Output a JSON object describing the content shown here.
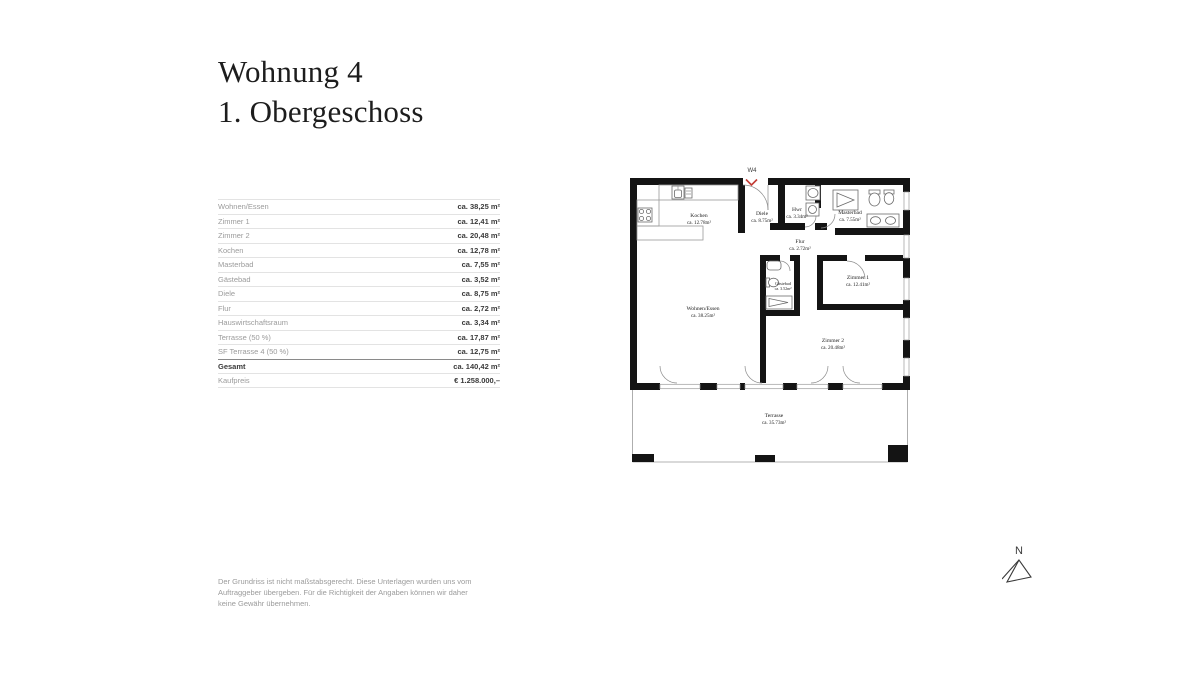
{
  "title": {
    "line1": "Wohnung 4",
    "line2": "1. Obergeschoss"
  },
  "area_table": {
    "rows": [
      {
        "label": "Wohnen/Essen",
        "value": "ca. 38,25 m²"
      },
      {
        "label": "Zimmer 1",
        "value": "ca. 12,41 m²"
      },
      {
        "label": "Zimmer 2",
        "value": "ca. 20,48 m²"
      },
      {
        "label": "Kochen",
        "value": "ca. 12,78 m²"
      },
      {
        "label": "Masterbad",
        "value": "ca. 7,55 m²"
      },
      {
        "label": "Gästebad",
        "value": "ca. 3,52 m²"
      },
      {
        "label": "Diele",
        "value": "ca. 8,75 m²"
      },
      {
        "label": "Flur",
        "value": "ca. 2,72 m²"
      },
      {
        "label": "Hauswirtschaftsraum",
        "value": "ca. 3,34 m²"
      },
      {
        "label": "Terrasse (50 %)",
        "value": "ca. 17,87 m²"
      },
      {
        "label": "SF Terrasse 4 (50 %)",
        "value": "ca. 12,75 m²"
      }
    ],
    "total": {
      "label": "Gesamt",
      "value": "ca. 140,42 m²"
    },
    "price": {
      "label": "Kaufpreis",
      "value": "€ 1.258.000,–"
    }
  },
  "floorplan": {
    "unit_label": "W4",
    "rooms": [
      {
        "name": "Kochen",
        "area": "ca. 12.78m²"
      },
      {
        "name": "Diele",
        "area": "ca. 8.75m²"
      },
      {
        "name": "Hwr",
        "area": "ca. 3.34m²"
      },
      {
        "name": "Masterbad",
        "area": "ca. 7.55m²"
      },
      {
        "name": "Flur",
        "area": "ca. 2.72m²"
      },
      {
        "name": "Gästebad",
        "area": "ca. 3.52m²"
      },
      {
        "name": "Zimmer 1",
        "area": "ca. 12.41m²"
      },
      {
        "name": "Wohnen/Essen",
        "area": "ca. 38.25m²"
      },
      {
        "name": "Zimmer 2",
        "area": "ca. 20.48m²"
      },
      {
        "name": "Terrasse",
        "area": "ca. 35.73m²"
      }
    ],
    "colors": {
      "wall": "#141414",
      "entrance_marker": "#c23b33"
    }
  },
  "compass": {
    "label": "N"
  },
  "footer": {
    "text": "Der Grundriss ist nicht maßstabsgerecht. Diese Unterlagen wurden uns vom Auftraggeber übergeben. Für die Richtigkeit der Angaben können wir daher keine Gewähr übernehmen."
  }
}
